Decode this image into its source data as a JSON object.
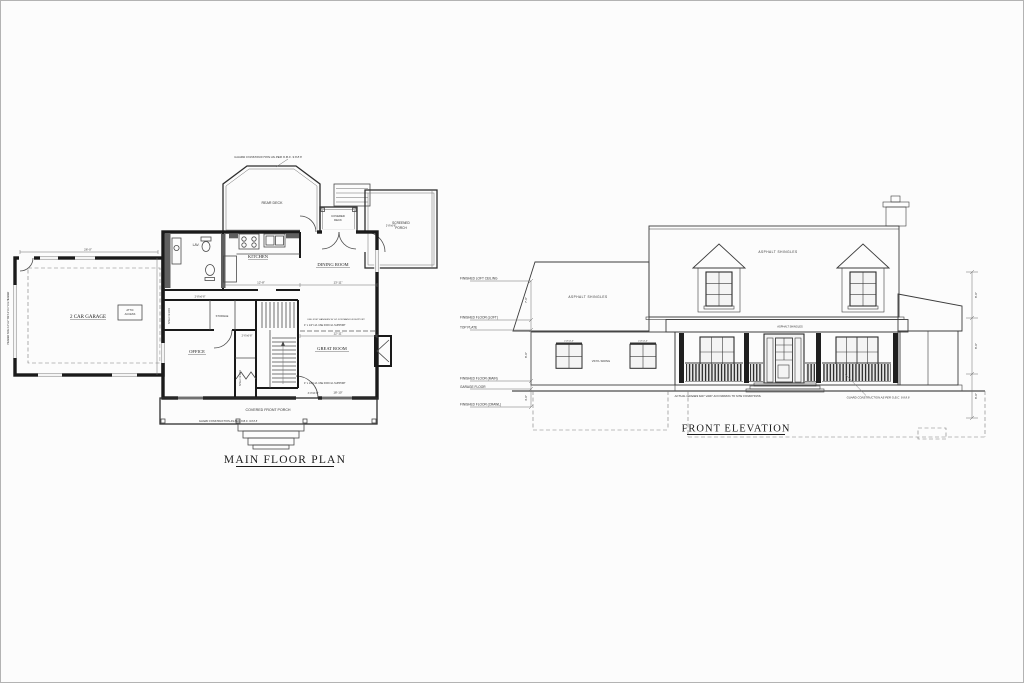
{
  "sheet": {
    "background": "#fcfcfc",
    "border_color": "#b3b3b3",
    "ink_color": "#1a1a1a"
  },
  "floor_plan": {
    "title": "MAIN FLOOR PLAN",
    "rooms": {
      "garage": "2 CAR GARAGE",
      "rear_deck": "REAR DECK",
      "covered_deck_1": "COVERED",
      "covered_deck_2": "DECK",
      "screened_porch_1": "SCREENED",
      "screened_porch_2": "PORCH",
      "lav": "LAV.",
      "kitchen": "KITCHEN",
      "dining": "DINING ROOM",
      "office": "OFFICE",
      "great": "GREAT ROOM",
      "front_porch": "COVERED FRONT PORCH",
      "storage": "STORAGE",
      "shelf_rod_a": "SHELF & ROD",
      "shelf_rod_b": "SHELF & ROD",
      "attic_1": "ATTIC",
      "attic_2": "ACCESS"
    },
    "notes": {
      "guard_top": "GUARD CONSTRUCTION AS PER O.B.C. 9.8.8.8",
      "guard_porch": "GUARD CONSTRUCTION AS PER O.B.C. 9.8.8.8",
      "lvl_a": "4\" x 1/4\" LVL USE FOR LVL SUPPORT",
      "lvl_b": "4\" x 1/4\" LVL USE FOR LVL SUPPORT",
      "joist": "USE JOIST HANGERS W/ LVL FOR MAIN FLR SUPPORT",
      "header": "HEADER SIZE 2-2\"x12\" OR 3-2\"x10\" LVL HEADER"
    },
    "dims": {
      "garage_w": "26'-0\"",
      "kitchen_w": "12'-8\"",
      "dining_w": "13'-11\"",
      "great_w1": "12'-11\"",
      "great_w2": "18'-10\"",
      "door_a": "2'-8\"x6'-8\"",
      "door_b": "2'-6\"x6'-8\"",
      "door_c": "3'-0\"x6'-8\"",
      "door_d": "2'-8\"x6'-8\""
    }
  },
  "elevation": {
    "title": "FRONT ELEVATION",
    "levels": {
      "l1": "FINISHED LOFT CEILING",
      "l2": "FINISHED FLOOR (LOFT)",
      "l3": "TOP PLATE",
      "l4": "FINISHED FLOOR (MAIN)",
      "l5": "GARAGE FLOOR",
      "l6": "FINISHED FLOOR (CRAWL)"
    },
    "dims": {
      "left_1": "7'-0\"",
      "left_2": "8'-0\"",
      "left_3": "4'-0\"",
      "right_1": "8'-0\"",
      "right_2": "8'-0\"",
      "right_3": "8'-0\""
    },
    "notes": {
      "shingles_main": "ASPHALT SHINGLES",
      "shingles_low": "ASPHALT SHINGLES",
      "shingles_left": "ASPHALT SHINGLES",
      "siding": "VINYL SIDING",
      "win_a": "2'-8\"x4'-0\"",
      "win_b": "2'-8\"x4'-0\"",
      "grades": "ACTUAL GRADES MAY VARY ACCORDING TO SITE CONDITIONS.",
      "guard": "GUARD CONSTRUCTION AS PER O.B.C. 9.8.8.8"
    }
  }
}
